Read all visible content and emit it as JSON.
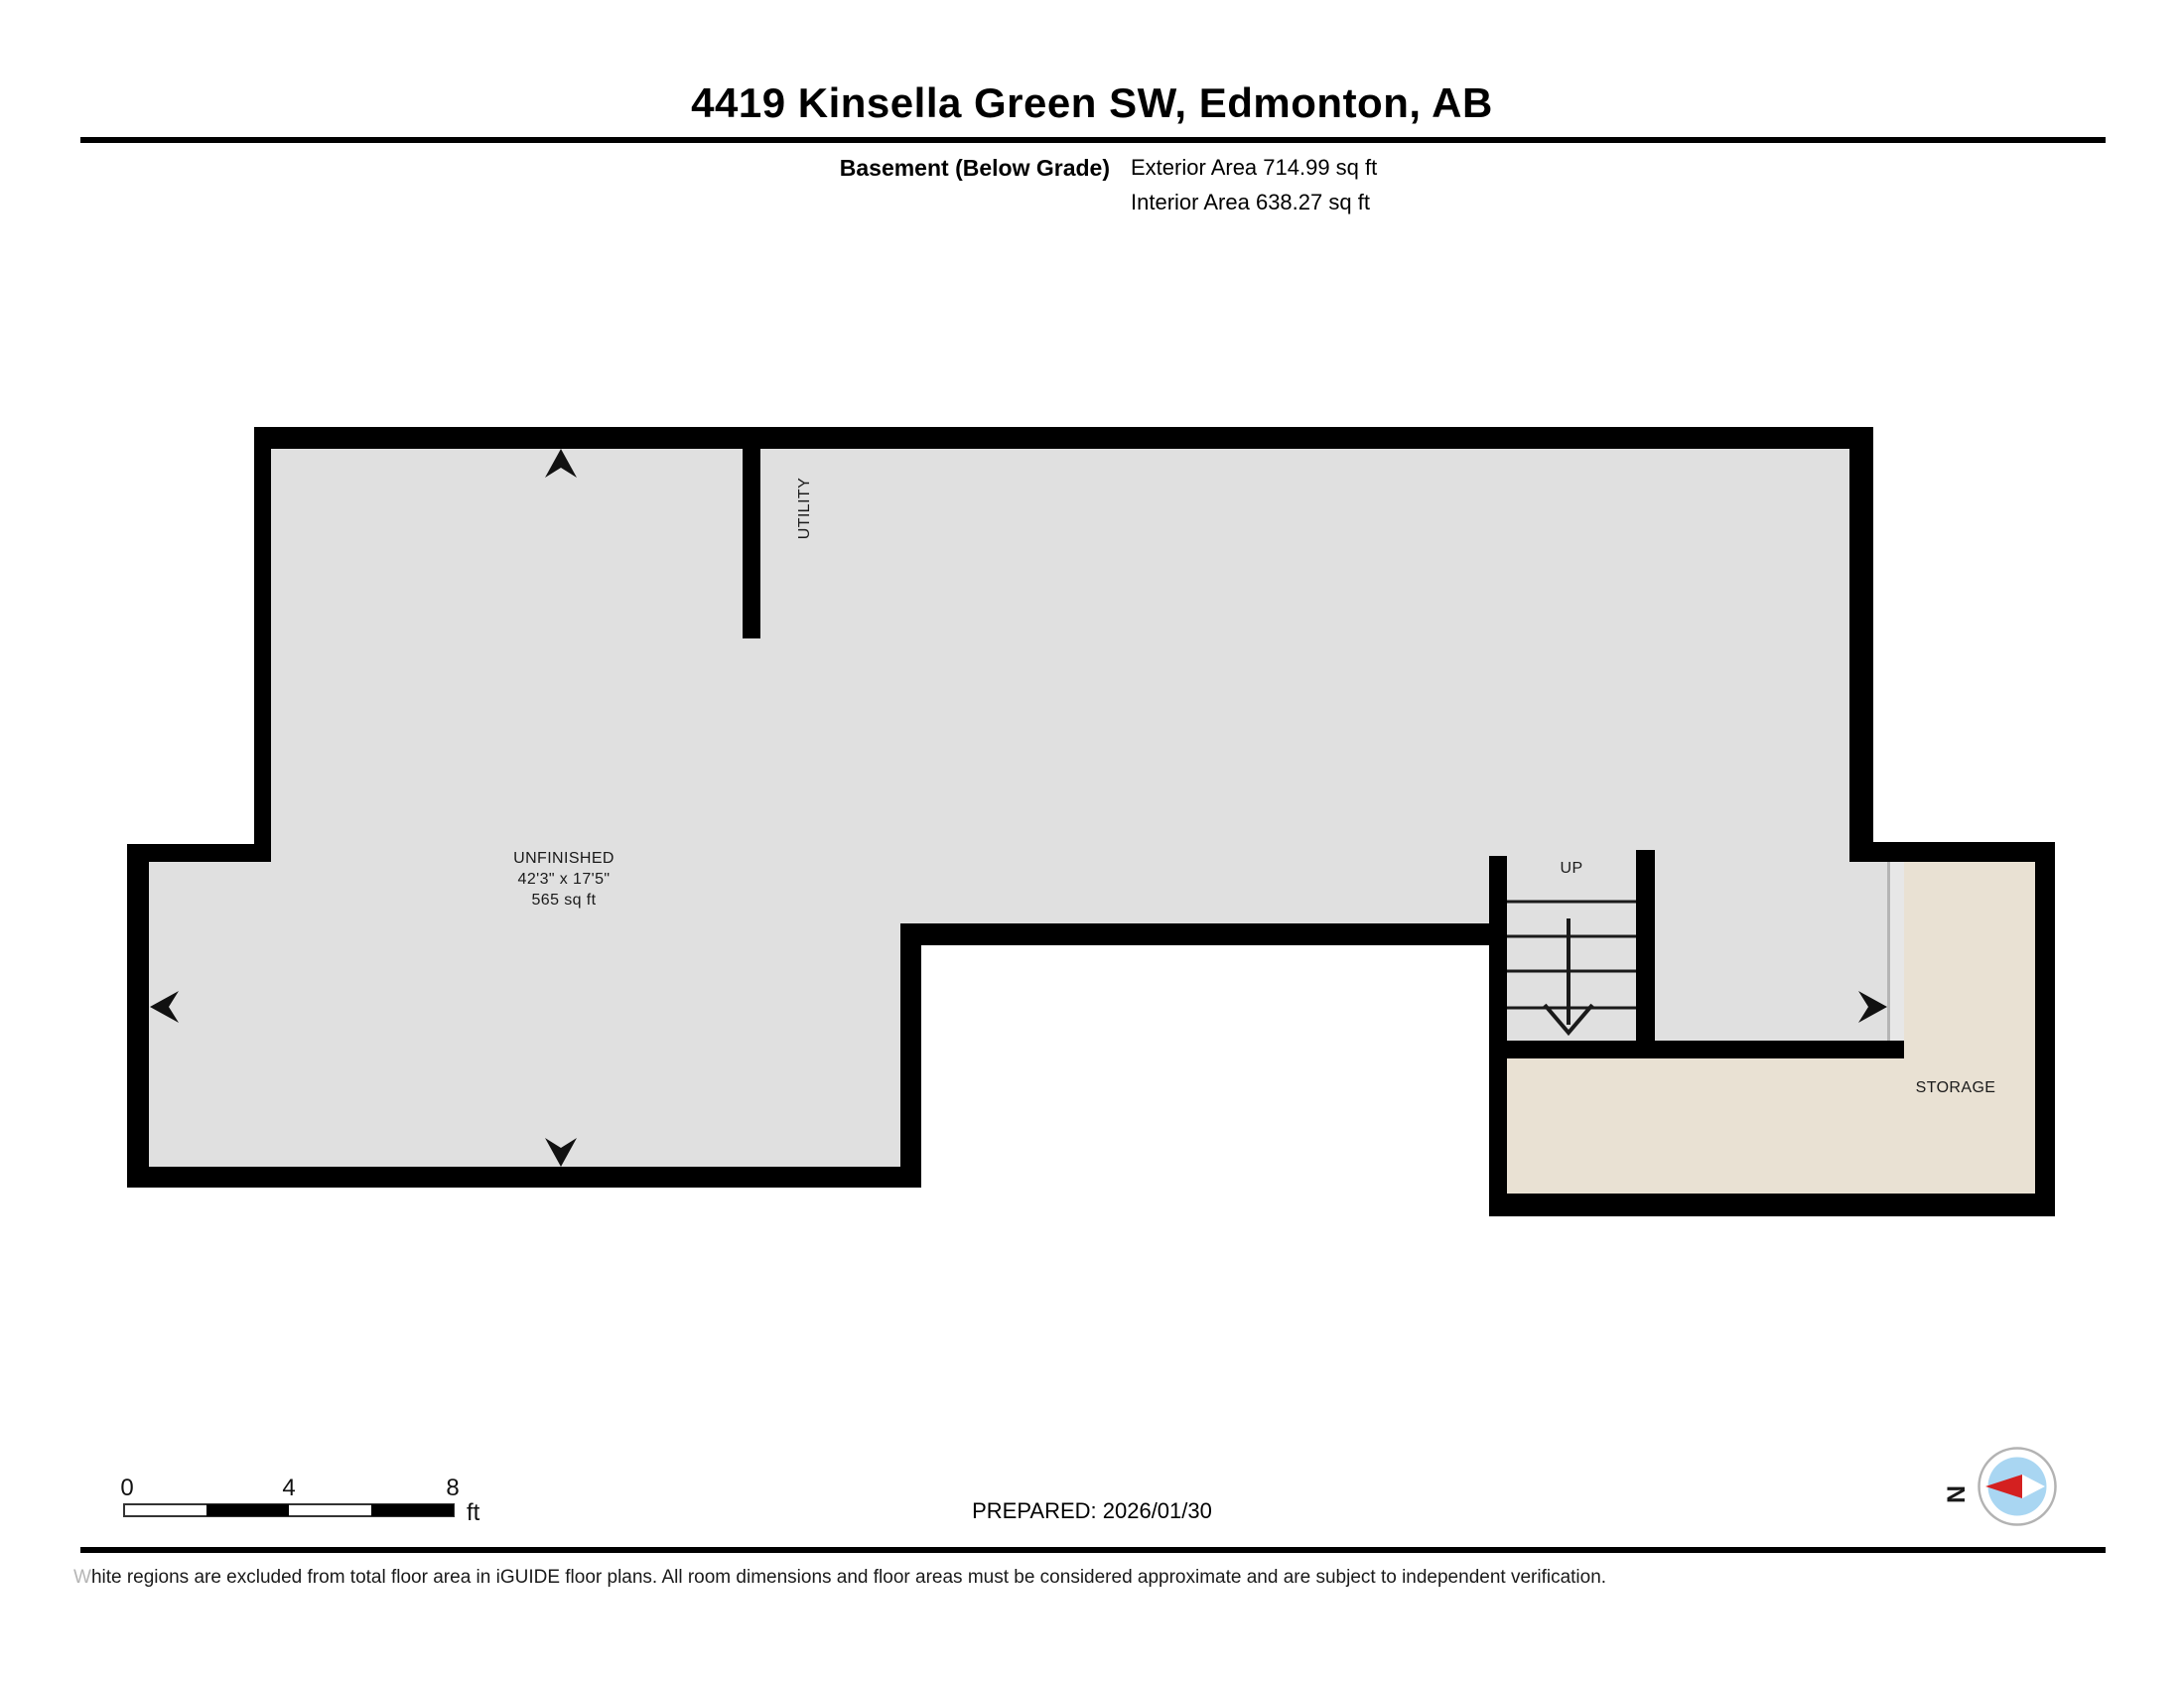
{
  "header": {
    "title": "4419 Kinsella Green SW, Edmonton, AB",
    "floor_label": "Basement (Below Grade)",
    "exterior_area": "Exterior Area 714.99 sq ft",
    "interior_area": "Interior Area 638.27 sq ft"
  },
  "plan": {
    "unfinished": {
      "name": "UNFINISHED",
      "dimensions": "42'3\" x 17'5\"",
      "area": "565 sq ft"
    },
    "utility": "UTILITY",
    "up": "UP",
    "storage": "STORAGE",
    "colors": {
      "wall": "#000000",
      "floor": "#e0e0e0",
      "storage_floor": "#e9e1d3",
      "excluded": "#ffffff",
      "door_band": "#e7e7e7"
    }
  },
  "footer": {
    "scale": {
      "ticks": [
        "0",
        "4",
        "8"
      ],
      "unit": "ft"
    },
    "prepared": "PREPARED: 2026/01/30",
    "compass": {
      "north_label": "N",
      "needle_red": "#d42020",
      "circle_blue": "#a9d6f2"
    },
    "disclaimer_w": "W",
    "disclaimer_text": "hite regions are excluded from total floor area in iGUIDE floor plans. All room dimensions and floor areas must be considered approximate and are subject to independent verification."
  }
}
